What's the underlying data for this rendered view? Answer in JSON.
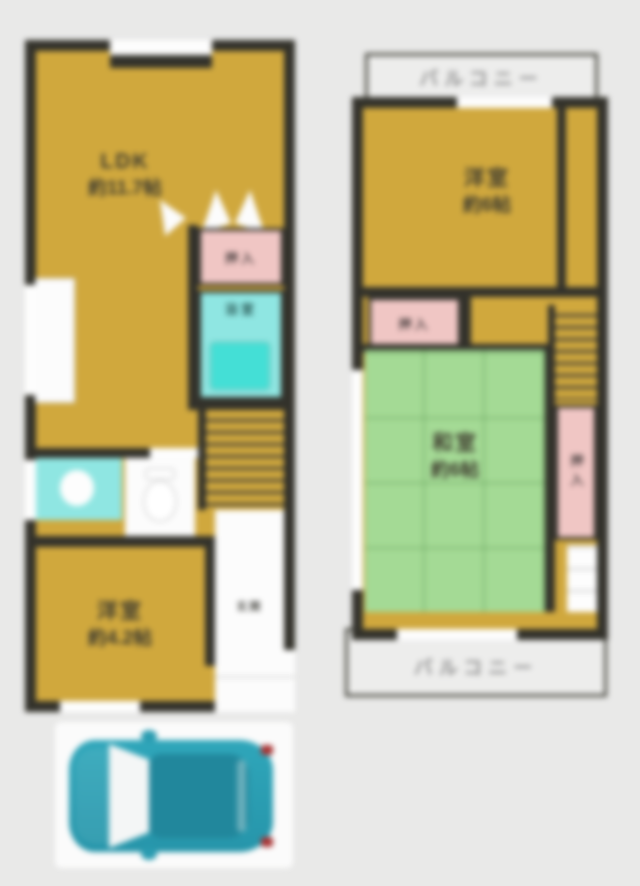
{
  "meta": {
    "type": "real-estate-floor-plan",
    "floors": 2
  },
  "colors": {
    "background": "#e9e9e8",
    "wall": "#33322b",
    "floor_yellow": "#d0a83d",
    "tatami_green": "#a4da95",
    "closet_pink": "#f0c6c4",
    "bath_teal": "#8fe6e2",
    "tub_teal": "#44dfd6",
    "balcony_gray": "#ededec",
    "car_teal": "#2b9fb4"
  },
  "floor1": {
    "ldk": {
      "label": "LDK",
      "size": "約11.7帖"
    },
    "closet": {
      "label": "押入"
    },
    "bath": {
      "label": "浴室"
    },
    "bedroom": {
      "label": "洋室",
      "size": "約4.2帖"
    },
    "entrance": {
      "label": "玄関"
    }
  },
  "floor2": {
    "balcony_top": {
      "label": "バルコニー"
    },
    "bedroom": {
      "label": "洋室",
      "size": "約6帖"
    },
    "closet_left": {
      "label": "押入"
    },
    "tatami": {
      "label": "和室",
      "size": "約6帖"
    },
    "closet_right": {
      "label": "押入"
    },
    "balcony_bottom": {
      "label": "バルコニー"
    }
  },
  "parking": {
    "vehicle": "car-top-view"
  }
}
